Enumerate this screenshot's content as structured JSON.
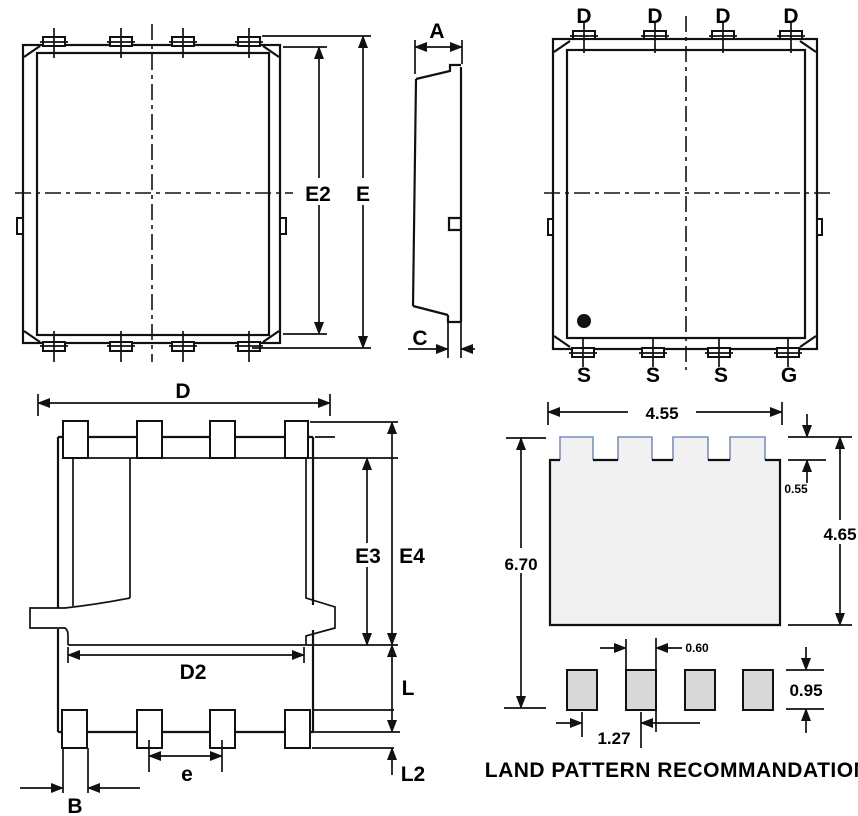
{
  "top_view": {
    "label_e2": "E2",
    "label_e": "E"
  },
  "side_view": {
    "label_a": "A",
    "label_c": "C"
  },
  "pin_view": {
    "top_pins": [
      "D",
      "D",
      "D",
      "D"
    ],
    "bottom_pins": [
      "S",
      "S",
      "S",
      "G"
    ]
  },
  "bottom_view": {
    "label_d": "D",
    "label_d2": "D2",
    "label_e3": "E3",
    "label_e4": "E4",
    "label_l": "L",
    "label_l2": "L2",
    "label_e": "e",
    "label_b": "B"
  },
  "land_pattern": {
    "title": "LAND PATTERN RECOMMANDATION",
    "dim_width": "4.55",
    "dim_tab_height": "0.55",
    "dim_pad_height": "4.65",
    "dim_total_height": "6.70",
    "dim_pad_width": "0.60",
    "dim_small_pad_height": "0.95",
    "dim_pitch": "1.27",
    "colors": {
      "pad_fill": "#f1f1f1",
      "pad_tab_stroke": "#7b8fc0",
      "small_pad_fill": "#d8d8d8",
      "line": "#111111"
    }
  }
}
